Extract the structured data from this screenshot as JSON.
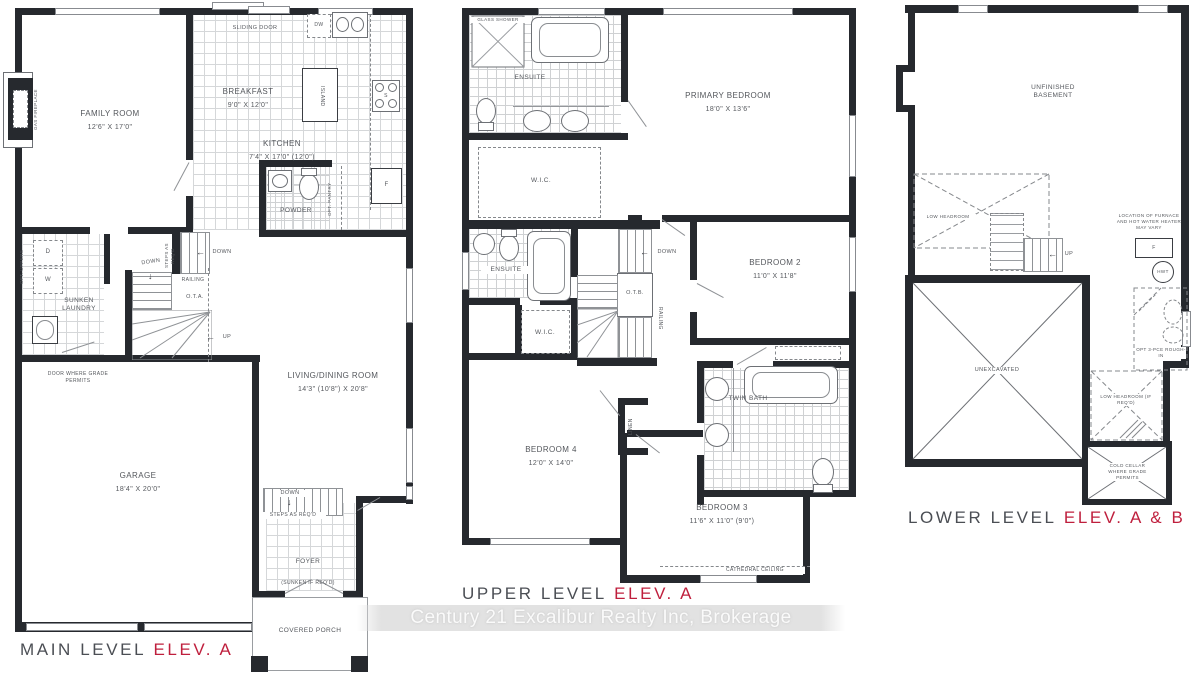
{
  "watermark": "Century 21 Excalibur Realty Inc, Brokerage",
  "accent_red": "#bf1f3d",
  "icons": {
    "down_arrow": "↓",
    "left_arrow": "←",
    "up_arrow": "↑"
  },
  "main": {
    "title": "MAIN LEVEL",
    "elev": "ELEV. A",
    "family_room": {
      "name": "FAMILY ROOM",
      "dims": "12'6\" X 17'0\""
    },
    "breakfast": {
      "name": "BREAKFAST",
      "dims": "9'0\" X 12'0\""
    },
    "kitchen": {
      "name": "KITCHEN",
      "dims": "7'4\" X 17'0\" (12'0\")"
    },
    "living_dining": {
      "name": "LIVING/DINING ROOM",
      "dims": "14'3\" (10'8\") X 20'8\""
    },
    "garage": {
      "name": "GARAGE",
      "dims": "18'4\" X 20'0\""
    },
    "foyer": {
      "name": "FOYER",
      "note": "(SUNKEN IF REQ'D)"
    },
    "covered_porch": "COVERED PORCH",
    "sunken_laundry": "SUNKEN LAUNDRY",
    "powder": "POWDER",
    "sliding_door": "SLIDING DOOR",
    "gas_fireplace": "GAS FIREPLACE",
    "island": "ISLAND",
    "opt_pantry": "OPT. PANTRY",
    "opt_uppers": "OPT. UPPERS",
    "dw": "DW",
    "stove": "S",
    "fridge": "F",
    "dryer": "D",
    "washer": "W",
    "down": "DOWN",
    "up": "UP",
    "steps_as_reqd": "STEPS AS REQ'D",
    "railing": "RAILING",
    "ota": "O.T.A.",
    "door_where": "DOOR WHERE GRADE PERMITS"
  },
  "upper": {
    "title": "UPPER LEVEL",
    "elev": "ELEV. A",
    "primary_bedroom": {
      "name": "PRIMARY BEDROOM",
      "dims": "18'0\" X 13'6\""
    },
    "bedroom2": {
      "name": "BEDROOM 2",
      "dims": "11'0\" X 11'8\""
    },
    "bedroom3": {
      "name": "BEDROOM 3",
      "dims": "11'6\" X 11'0\" (9'0\")"
    },
    "bedroom4": {
      "name": "BEDROOM 4",
      "dims": "12'0\" X 14'0\""
    },
    "ensuite": "ENSUITE",
    "glass_shower": "GLASS SHOWER",
    "wic": "W.I.C.",
    "twin_bath": "TWIN BATH",
    "linen": "LINEN",
    "down": "DOWN",
    "otb": "O.T.B.",
    "railing": "RAILING",
    "cathedral_ceiling": "CATHEDRAL CEILING"
  },
  "lower": {
    "title": "LOWER LEVEL",
    "elev": "ELEV. A & B",
    "unfinished_basement": "UNFINISHED BASEMENT",
    "low_headroom": "LOW HEADROOM",
    "low_headroom_reqd": "LOW HEADROOM (IF REQ'D)",
    "unexcavated": "UNEXCAVATED",
    "furnace_note": "LOCATION OF FURNACE AND HOT WATER HEATER MAY VARY",
    "rough_in": "OPT 3-PCE ROUGH-IN",
    "cold_cellar": "COLD CELLAR WHERE GRADE PERMITS",
    "up": "UP",
    "f": "F",
    "hwt": "HWT"
  }
}
